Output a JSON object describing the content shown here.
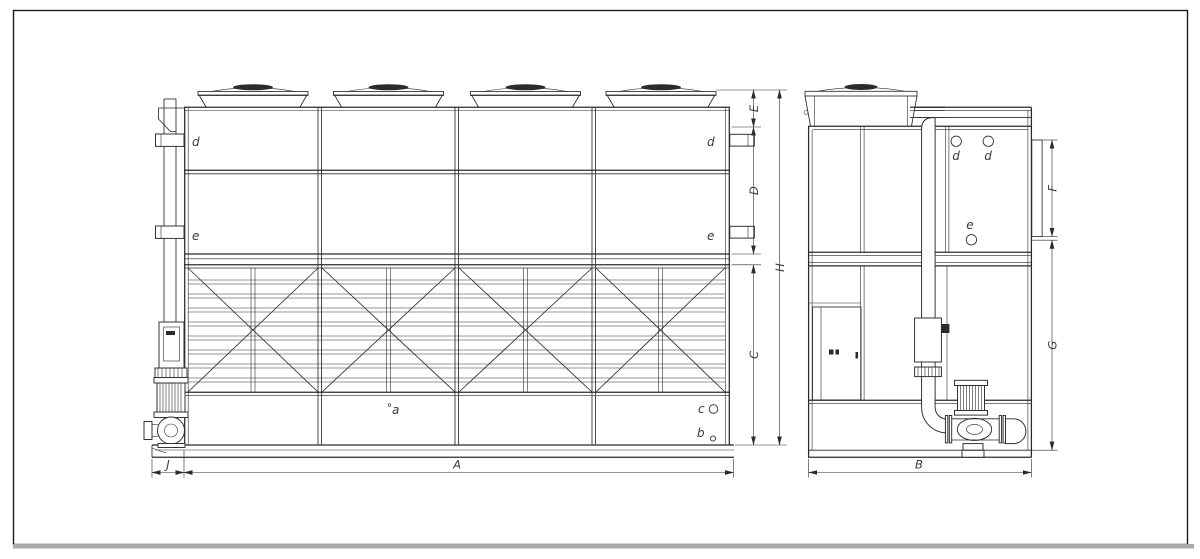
{
  "colors": {
    "background": "#ffffff",
    "line": "#2b2b2b",
    "label": "#3a3a3a",
    "page_border": "#1c1c1c",
    "footer_bar": "#a9a9a9"
  },
  "front_view": {
    "connection_labels": {
      "d_left": "d",
      "e_left": "e",
      "d_right": "d",
      "e_right": "e"
    },
    "basin_labels": {
      "a": "a",
      "b": "b",
      "c": "c"
    },
    "dimensions": {
      "A": "A",
      "J": "J",
      "C": "C",
      "D": "D",
      "E": "E",
      "H": "H"
    }
  },
  "side_view": {
    "connection_labels": {
      "d_front": "d",
      "d_rear": "d",
      "e": "e"
    },
    "dimensions": {
      "B": "B",
      "F": "F",
      "G": "G"
    }
  }
}
